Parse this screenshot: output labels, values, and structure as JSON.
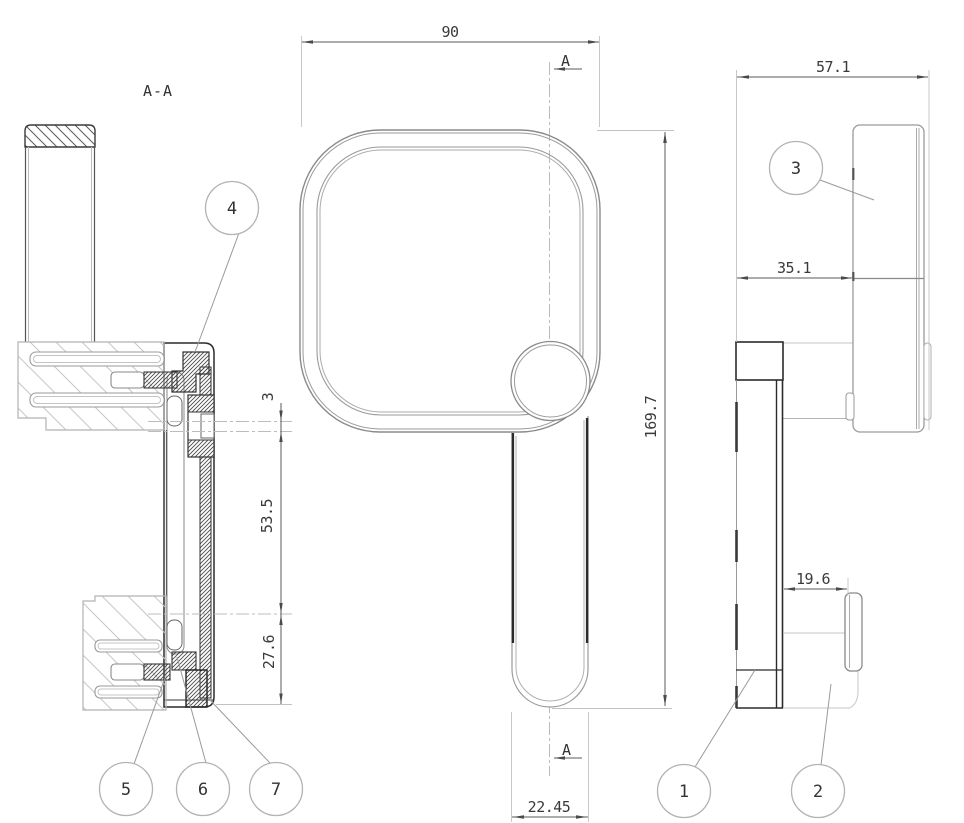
{
  "labels": {
    "section": "A-A",
    "cut_letter": "A"
  },
  "dimensions": {
    "front_width": "90",
    "front_height": "169.7",
    "grip_width": "22.45",
    "side_total_depth": "57.1",
    "head_depth": "35.1",
    "knob_depth": "19.6",
    "axis_offset": "3",
    "axis_to_knob": "53.5",
    "knob_to_bottom": "27.6"
  },
  "balloons": [
    {
      "label": "1"
    },
    {
      "label": "2"
    },
    {
      "label": "3"
    },
    {
      "label": "4"
    },
    {
      "label": "5"
    },
    {
      "label": "6"
    },
    {
      "label": "7"
    }
  ],
  "colors": {
    "background": "#ffffff",
    "line_dark": "#2b2b2b",
    "line_medium": "#8a8a8a",
    "line_light": "#c6c6c6",
    "dimension": "#4a4a4a",
    "text": "#333333",
    "balloon_stroke": "#b3b3b3"
  }
}
